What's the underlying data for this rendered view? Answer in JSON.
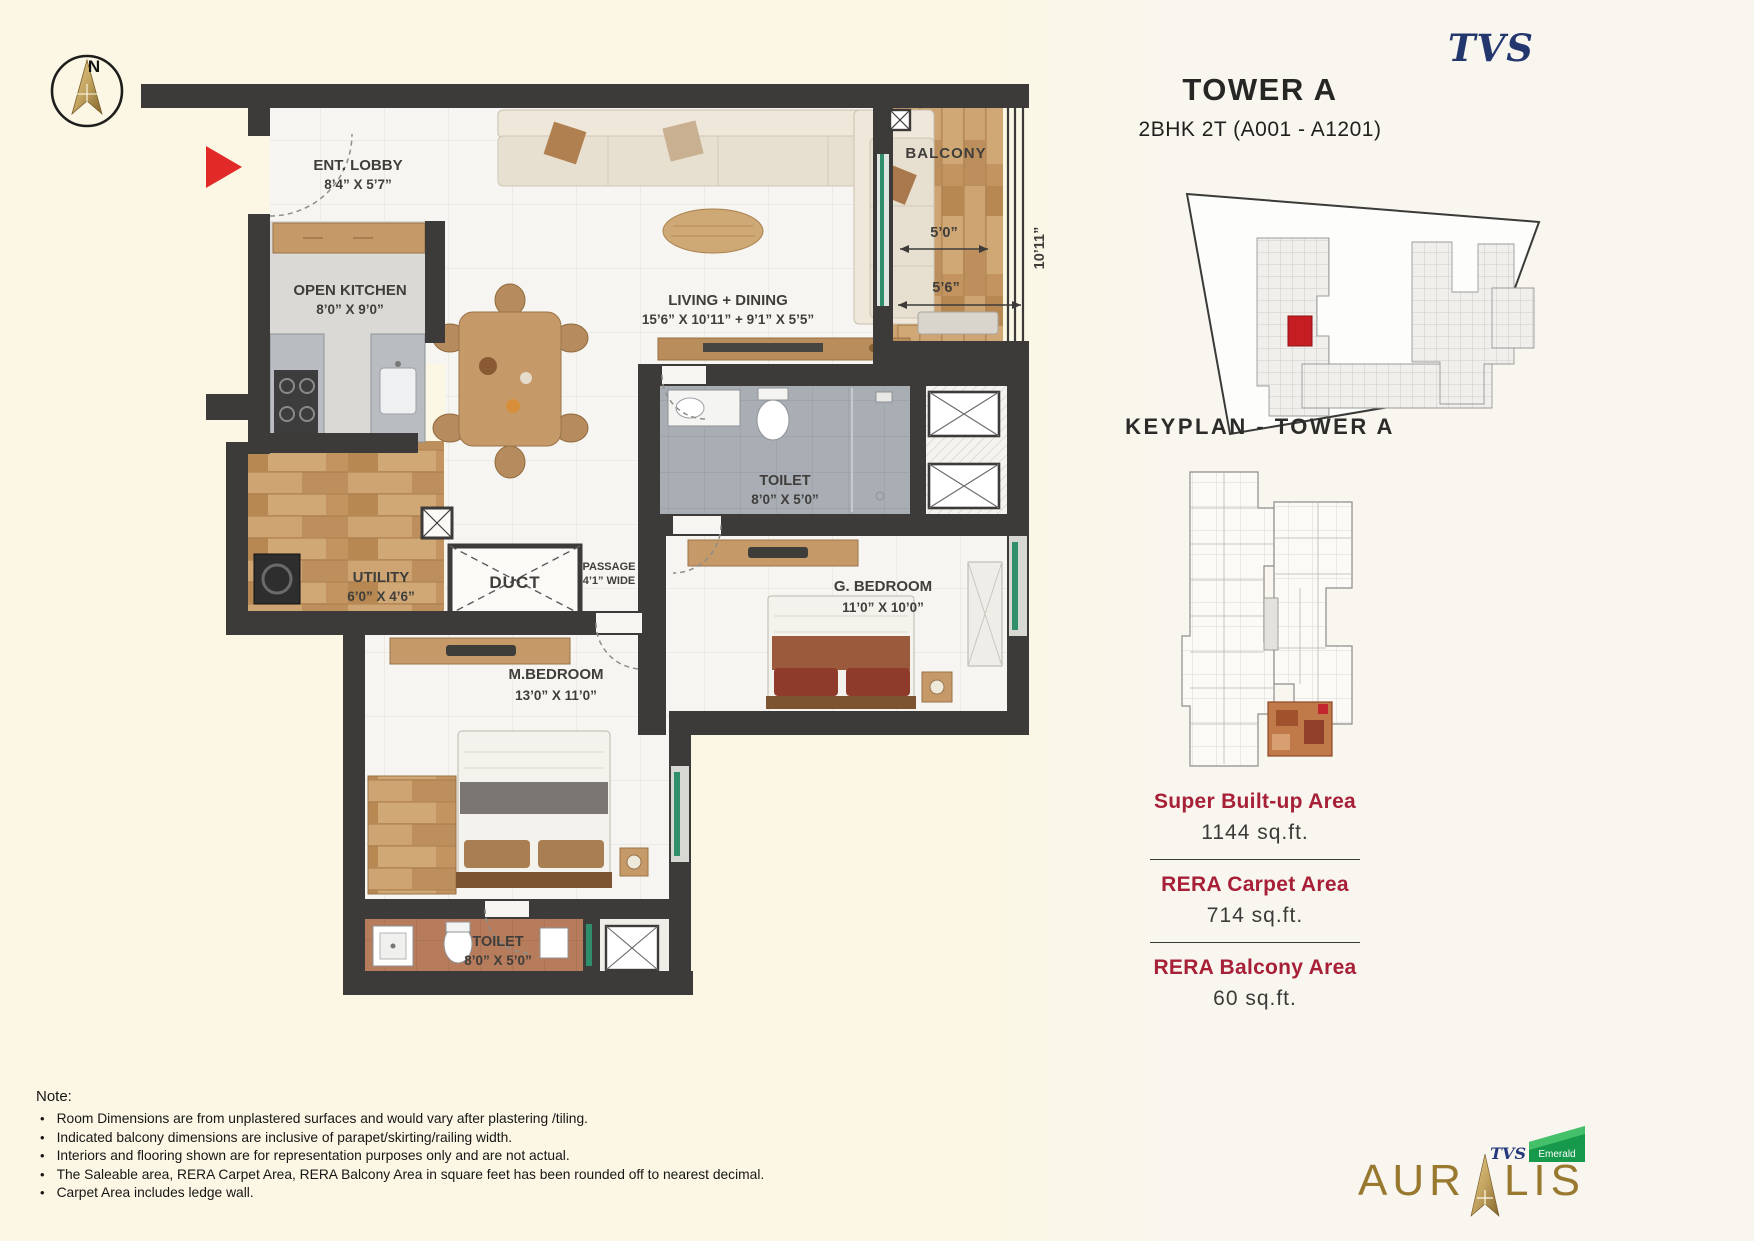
{
  "brand": {
    "tvs_logo": "TVS",
    "auralis_prefix": "AUR",
    "auralis_suffix": "LIS",
    "emerald_tvs": "TVS",
    "emerald_label": "Emerald"
  },
  "header": {
    "title": "TOWER A",
    "subtitle": "2BHK 2T (A001 - A1201)"
  },
  "compass": {
    "north": "N"
  },
  "keyplan": {
    "title": "KEYPLAN - TOWER A"
  },
  "areas": [
    {
      "label": "Super Built-up Area",
      "value": "1144 sq.ft."
    },
    {
      "label": "RERA Carpet Area",
      "value": "714 sq.ft."
    },
    {
      "label": "RERA Balcony Area",
      "value": "60 sq.ft."
    }
  ],
  "floorplan": {
    "rooms": [
      {
        "name": "ENT. LOBBY",
        "dims": "8’4” X 5’7”"
      },
      {
        "name": "OPEN KITCHEN",
        "dims": "8’0” X 9’0”"
      },
      {
        "name": "LIVING + DINING",
        "dims": "15’6” X 10’11” + 9’1” X 5’5”"
      },
      {
        "name": "BALCONY",
        "dims": ""
      },
      {
        "name": "TOILET",
        "dims": "8’0” X 5’0”"
      },
      {
        "name": "UTILITY",
        "dims": "6’0” X 4’6”"
      },
      {
        "name": "DUCT",
        "dims": ""
      },
      {
        "name": "PASSAGE",
        "dims": "4’1” WIDE"
      },
      {
        "name": "G. BEDROOM",
        "dims": "11’0” X 10’0”"
      },
      {
        "name": "M.BEDROOM",
        "dims": "13’0” X 11’0”"
      },
      {
        "name": "TOILET",
        "dims": "8’0” X 5’0”"
      }
    ],
    "balcony_dims": {
      "d1": "5’0”",
      "d2": "5’6”",
      "d3": "10’11”"
    }
  },
  "note": {
    "title": "Note:",
    "items": [
      "Room Dimensions are from unplastered surfaces and would vary after plastering /tiling.",
      "Indicated balcony dimensions are inclusive of parapet/skirting/railing width.",
      "Interiors and flooring shown are for representation purposes only and are not actual.",
      "The Saleable area, RERA Carpet Area, RERA Balcony Area in square feet has been rounded off to nearest decimal.",
      "Carpet Area includes ledge wall."
    ]
  }
}
